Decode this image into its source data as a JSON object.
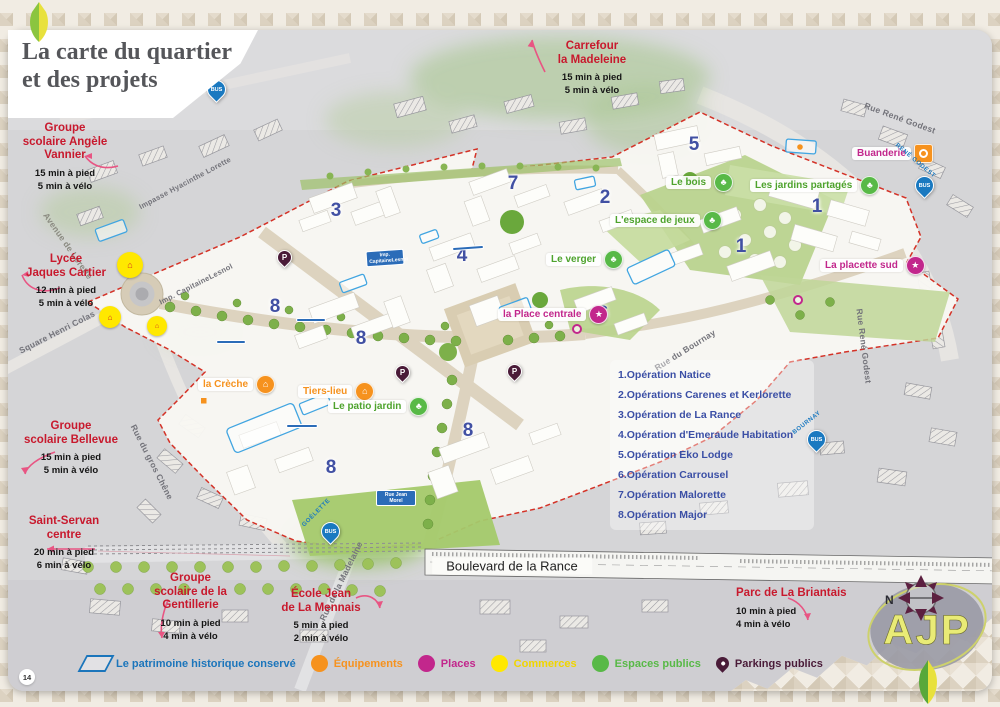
{
  "page": {
    "number": "14"
  },
  "title": {
    "line1": "La carte du quartier",
    "line2": "et des projets"
  },
  "poi_annotations": [
    {
      "lines": [
        "Carrefour",
        "la Madeleine"
      ],
      "walk": "15 min à pied",
      "bike": "5 min à vélo"
    },
    {
      "lines": [
        "Groupe",
        "scolaire Angèle",
        "Vannier"
      ],
      "walk": "15 min à pied",
      "bike": "5 min à vélo"
    },
    {
      "lines": [
        "Lycée",
        "Jaques Cartier"
      ],
      "walk": "12 min à pied",
      "bike": "5 min à vélo"
    },
    {
      "lines": [
        "Groupe",
        "scolaire Bellevue"
      ],
      "walk": "15 min à pied",
      "bike": "5 min à vélo"
    },
    {
      "lines": [
        "Saint-Servan",
        "centre"
      ],
      "walk": "20 min à pied",
      "bike": "6 min à vélo"
    },
    {
      "lines": [
        "Groupe",
        "scolaire de la",
        "Gentillerie"
      ],
      "walk": "10 min à pied",
      "bike": "4 min à vélo"
    },
    {
      "lines": [
        "École Jean",
        "de La Mennais"
      ],
      "walk": "5 min à pied",
      "bike": "2 min à vélo"
    },
    {
      "lines": [
        "Parc de La Briantais"
      ],
      "walk": "10  min à pied",
      "bike": "4 min à vélo"
    }
  ],
  "operations": {
    "items": [
      "1.Opération Natice",
      "2.Opérations Carenes et Kerlorette",
      "3.Opération de La Rance",
      "4.Opération d'Emeraude Habitation",
      "5.Opération Eko Lodge",
      "6.Opération Carrousel",
      "7.Opération Malorette",
      "8.Opération Major"
    ]
  },
  "map_labels": [
    {
      "text": "Buanderie",
      "text_color": "#c2278c",
      "icon_color": "#f6921e"
    },
    {
      "text": "Les jardins partagés",
      "text_color": "#4ea32d",
      "icon_color": "#58b947"
    },
    {
      "text": "Le bois",
      "text_color": "#4ea32d",
      "icon_color": "#58b947"
    },
    {
      "text": "L'espace de jeux",
      "text_color": "#4ea32d",
      "icon_color": "#58b947"
    },
    {
      "text": "Le verger",
      "text_color": "#4ea32d",
      "icon_color": "#58b947"
    },
    {
      "text": "la Place centrale",
      "text_color": "#c2278c",
      "icon_color": "#c2278c"
    },
    {
      "text": "La placette sud",
      "text_color": "#c2278c",
      "icon_color": "#c2278c"
    },
    {
      "text": "la Crèche",
      "text_color": "#f6921e",
      "icon_color": "#f6921e"
    },
    {
      "text": "Tiers-lieu",
      "text_color": "#f6921e",
      "icon_color": "#f6921e"
    },
    {
      "text": "Le patio jardin",
      "text_color": "#4ea32d",
      "icon_color": "#58b947"
    }
  ],
  "plot_numbers": [
    {
      "n": "3"
    },
    {
      "n": "7"
    },
    {
      "n": "2"
    },
    {
      "n": "5"
    },
    {
      "n": "1"
    },
    {
      "n": "1"
    },
    {
      "n": "4"
    },
    {
      "n": "8"
    },
    {
      "n": "8"
    },
    {
      "n": "6"
    },
    {
      "n": "8"
    },
    {
      "n": "8"
    }
  ],
  "streets": [
    {
      "name": "Rue René Godest"
    },
    {
      "name": "Rue René Godest"
    },
    {
      "name": "Avenue de Lorette"
    },
    {
      "name": "Square Henri Colas"
    },
    {
      "name": "Impasse Hyacinthe Lorette"
    },
    {
      "name": "Imp. CapitaineLesnol"
    },
    {
      "name": "Rue du gros Chêne"
    },
    {
      "name": "Rue du Bournay"
    },
    {
      "name": "Rue de la Madelaine"
    },
    {
      "name": "Boulevard de la Rance"
    },
    {
      "name": "Rue Jean Morel"
    }
  ],
  "bus_stops": [
    {
      "label": "LORETTE",
      "badge": "BUS"
    },
    {
      "label": "RENÉ GODEST",
      "badge": "BUS"
    },
    {
      "label": "BOURNAY",
      "badge": "BUS"
    },
    {
      "label": "GOÉLETTE",
      "badge": "BUS"
    }
  ],
  "parking": {
    "letter": "P"
  },
  "legend": {
    "items": [
      {
        "label": "Le patrimoine historique conservé",
        "color": "#1b75bb",
        "type": "outline"
      },
      {
        "label": "Équipements",
        "color": "#f6921e",
        "type": "dot"
      },
      {
        "label": "Places",
        "color": "#c2278c",
        "type": "dot"
      },
      {
        "label": "Commerces",
        "color": "#f0d500",
        "type": "dot"
      },
      {
        "label": "Espaces publics",
        "color": "#58b947",
        "type": "dot"
      },
      {
        "label": "Parkings publics",
        "color": "#4a1b38",
        "type": "pin"
      }
    ]
  },
  "compass": {
    "north": "N"
  },
  "logo": {
    "text": "AJP"
  },
  "colors": {
    "annotation_red": "#c8192d",
    "operations_blue": "#3b4fa5",
    "plan_boundary_red": "#d43227",
    "bus_blue": "#1a79c0"
  }
}
